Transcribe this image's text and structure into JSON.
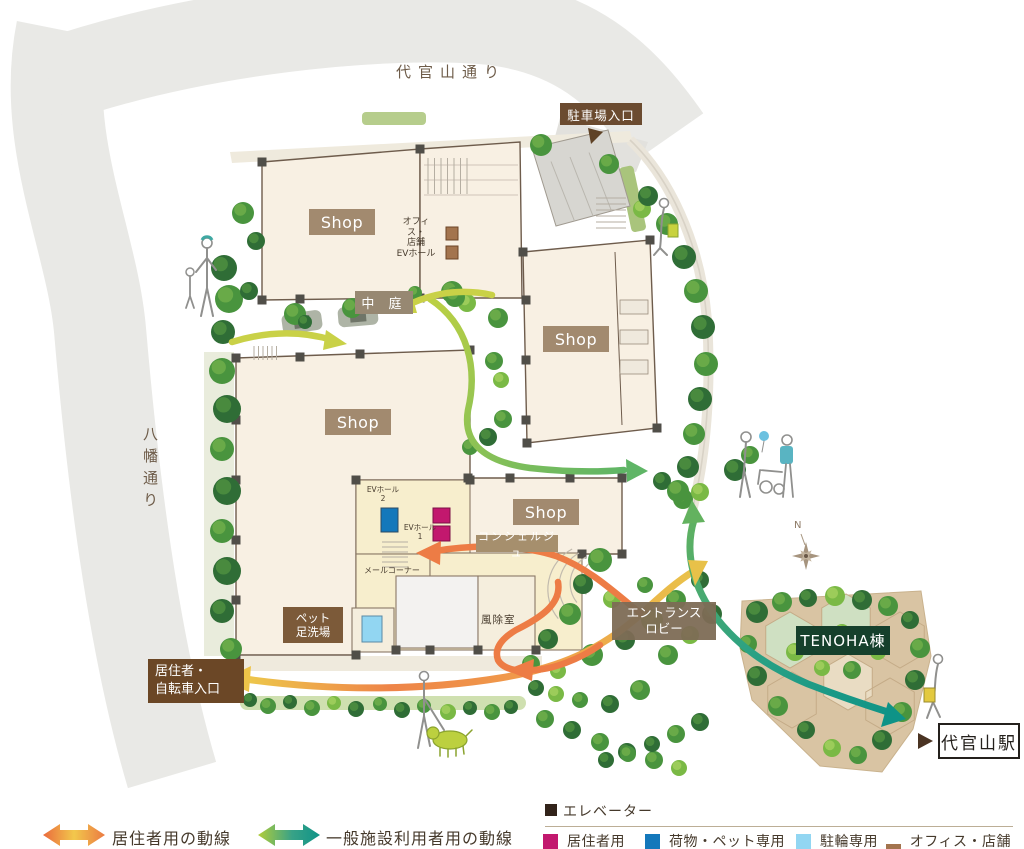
{
  "map": {
    "streets": {
      "top": "代官山通り",
      "left": "八幡通り"
    },
    "shop_label": "Shop",
    "badges": {
      "parking_entrance": "駐車場入口",
      "courtyard": "中 庭",
      "office_ev": [
        "オフィス・",
        "店舗",
        "EVホール"
      ],
      "ev_hall_2": [
        "EVホール",
        "2"
      ],
      "ev_hall_1": [
        "EVホール",
        "1"
      ],
      "mail_corner": "メールコーナー",
      "concierge": "コンシェルジュ",
      "windbreak": "風除室",
      "pet_wash": [
        "ペット",
        "足洗場"
      ],
      "entrance_lobby": [
        "エントランス",
        "ロビー"
      ],
      "resident_entrance": [
        "居住者・",
        "自転車入口"
      ],
      "tenoha": "TENOHA棟",
      "station": "代官山駅",
      "compass_north": "N"
    }
  },
  "legend": {
    "flows": {
      "resident": {
        "label": "居住者用の動線",
        "color_head": "#ea6a3d",
        "color_mid": "#f2c84c"
      },
      "general": {
        "label": "一般施設利用者用の動線",
        "color_start": "#b2cd3a",
        "color_end": "#0f9488"
      }
    },
    "elevator": {
      "title": "エレベーター",
      "title_square_color": "#32231a",
      "items": [
        {
          "label": "居住者用",
          "color": "#c2186e"
        },
        {
          "label": "荷物・ペット専用",
          "color": "#1478bb"
        },
        {
          "label": "駐輪専用",
          "color": "#92d6f2"
        },
        {
          "label": "オフィス・店舗用",
          "color": "#a3744e"
        }
      ]
    }
  }
}
